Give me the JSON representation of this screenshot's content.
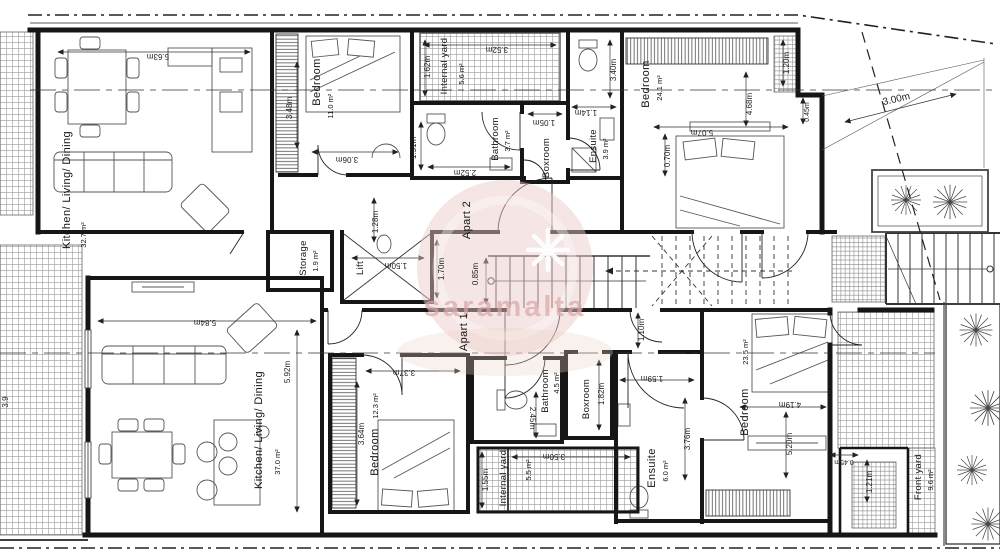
{
  "watermark": {
    "text": "saramalta",
    "accent_color": "#eccaca"
  },
  "labels": {
    "a2_kld_name": "Kitchen/ Living/ Dining",
    "a2_kld_area": "32.7 m²",
    "a2_kld_w": "5.63m",
    "a2_bed1_name": "Bedroom",
    "a2_bed1_area": "11.0 m²",
    "a2_bed1_d": "3.48m",
    "a2_bed1_w": "3.06m",
    "a2_yard_name": "Internal yard",
    "a2_yard_area": "5.6 m²",
    "a2_yard_w": "3.52m",
    "a2_yard_d": "1.62m",
    "a2_bath_name": "Bathroom",
    "a2_bath_area": "3.7 m²",
    "a2_bath_w": "2.52m",
    "a2_bath_d": "1.51m",
    "a2_box_name": "Boxroom",
    "a2_box_w": "1.05m",
    "a2_ens_name": "Ensuite",
    "a2_ens_area": "3.9 m²",
    "a2_ens_w": "1.14m",
    "a2_ens_d": "3.40m",
    "a2_bed2_name": "Bedroom",
    "a2_bed2_area": "24.1 m²",
    "a2_bed2_w": "5.07m",
    "a2_bed2_d": "4.68m",
    "a2_bed2_off": "0.70m",
    "a2_bed2_cl": "1.20m",
    "a2_bed2_s": "0.45m",
    "a2_back": "3.00m",
    "core_storage_name": "Storage",
    "core_storage_area": "1.9 m²",
    "core_lift": "Lift",
    "core_lift_d": "1.70m",
    "core_lift_w": "1.50m",
    "core_a2": "Apart 2",
    "core_a1": "Apart 1",
    "core_stair": "0.85m",
    "core_corr": "1.28m",
    "a1_kld_name": "Kitchen/ Living/ Dining",
    "a1_kld_area": "37.0 m²",
    "a1_kld_w": "5.84m",
    "a1_kld_d": "5.92m",
    "a1_side": "3.9",
    "a1_bed1_name": "Bedroom",
    "a1_bed1_area": "12.3 m²",
    "a1_bed1_d": "3.64m",
    "a1_bed1_w": "3.37m",
    "a1_bath_name": "Bathroom",
    "a1_bath_area": "4.5 m²",
    "a1_bath_d": "2.45m",
    "a1_yard_name": "Internal yard",
    "a1_yard_area": "5.5 m²",
    "a1_yard_w": "3.50m",
    "a1_yard_d": "1.55m",
    "a1_box_name": "Boxroom",
    "a1_box_d": "1.82m",
    "a1_ens_name": "Ensuite",
    "a1_ens_area": "6.0 m²",
    "a1_ens_d": "3.76m",
    "a1_ens_w": "1.59m",
    "a1_ens_door": "1.10m",
    "a1_bed2_name": "Bedroom",
    "a1_bed2_area": "23.5 m²",
    "a1_bed2_w": "4.19m",
    "a1_bed2_d": "5.20m",
    "a1_bed2_s": "0.45m",
    "a1_fy_name": "Front yard",
    "a1_fy_area": "9.6 m²",
    "a1_fy_w": "1.21m"
  }
}
